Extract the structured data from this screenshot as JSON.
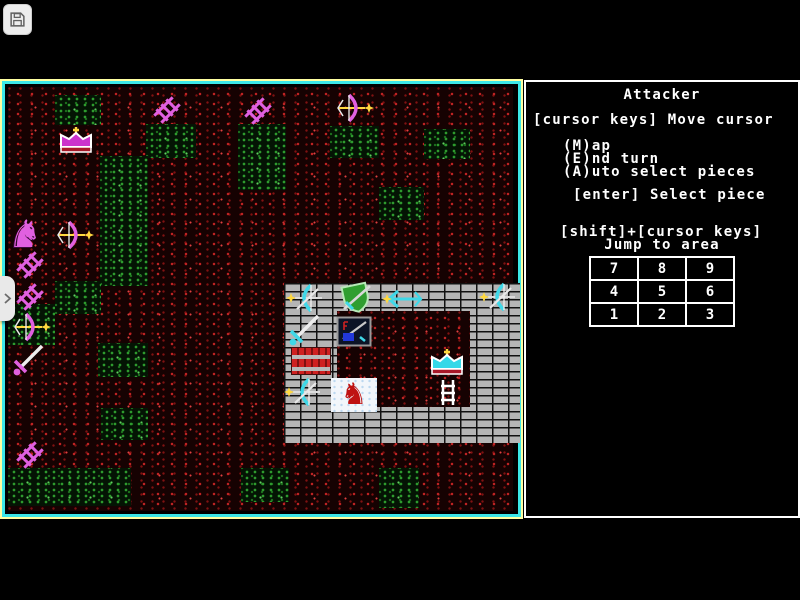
{
  "toolbar": {
    "save_icon": "floppy-disk"
  },
  "drawer": {
    "icon": "chevron-right"
  },
  "sidebar": {
    "title": "Attacker",
    "lines": [
      "[cursor keys] Move cursor",
      "(M)ap",
      "(E)nd turn",
      "(A)uto select pieces",
      "[enter] Select piece",
      "[shift]+[cursor keys]",
      "Jump to area"
    ],
    "jump_grid": {
      "rows": [
        [
          "7",
          "8",
          "9"
        ],
        [
          "4",
          "5",
          "6"
        ],
        [
          "1",
          "2",
          "3"
        ]
      ]
    }
  },
  "colors": {
    "map_border_outer": "#ffffa2",
    "map_border_inner": "#3ce8e8",
    "sidebar_border": "#ffffff",
    "text": "#ffffff",
    "ground_red": "#c22424",
    "grass_green": "#2e9b2e",
    "brick_gray": "#b5b5b5",
    "piece_pink": "#e060e0",
    "piece_cyan": "#40d8e8",
    "star_yellow": "#ffd840",
    "shield_green": "#2f9e2f"
  },
  "map": {
    "green_patches": [
      [
        55,
        95,
        46,
        30
      ],
      [
        146,
        124,
        50,
        34
      ],
      [
        238,
        124,
        48,
        66
      ],
      [
        100,
        156,
        48,
        130
      ],
      [
        330,
        126,
        49,
        32
      ],
      [
        424,
        129,
        46,
        30
      ],
      [
        379,
        187,
        45,
        33
      ],
      [
        55,
        281,
        46,
        33
      ],
      [
        8,
        304,
        47,
        41
      ],
      [
        98,
        343,
        50,
        34
      ],
      [
        101,
        408,
        47,
        32
      ],
      [
        8,
        468,
        123,
        38
      ],
      [
        241,
        468,
        48,
        34
      ],
      [
        379,
        468,
        40,
        40
      ]
    ],
    "castle": {
      "x": 284,
      "y": 283,
      "w": 236,
      "h": 160,
      "courtyard": {
        "x": 337,
        "y": 311,
        "w": 133,
        "h": 96
      }
    },
    "pieces": [
      {
        "type": "ladder",
        "x": 152,
        "y": 95
      },
      {
        "type": "ladder",
        "x": 243,
        "y": 96
      },
      {
        "type": "bow-pink",
        "x": 335,
        "y": 93
      },
      {
        "type": "crown-magenta",
        "x": 57,
        "y": 126
      },
      {
        "type": "horse-pink",
        "x": 8,
        "y": 216
      },
      {
        "type": "bow-pink",
        "x": 55,
        "y": 220
      },
      {
        "type": "ladder",
        "x": 15,
        "y": 250
      },
      {
        "type": "ladder",
        "x": 15,
        "y": 282
      },
      {
        "type": "bow-pink",
        "x": 12,
        "y": 312
      },
      {
        "type": "sword-pink",
        "x": 10,
        "y": 342
      },
      {
        "type": "ladder",
        "x": 15,
        "y": 440
      },
      {
        "type": "bow-cyan",
        "x": 285,
        "y": 283
      },
      {
        "type": "shield-green",
        "x": 336,
        "y": 281
      },
      {
        "type": "arrow-cyan",
        "x": 382,
        "y": 288
      },
      {
        "type": "bow-cyan",
        "x": 478,
        "y": 282
      },
      {
        "type": "sword-cyan",
        "x": 286,
        "y": 312
      },
      {
        "type": "emblem",
        "x": 336,
        "y": 316
      },
      {
        "type": "crate",
        "x": 291,
        "y": 347
      },
      {
        "type": "crown-cyan",
        "x": 428,
        "y": 348
      },
      {
        "type": "bow-cyan",
        "x": 283,
        "y": 377
      },
      {
        "type": "horse-red-tile",
        "x": 331,
        "y": 378
      },
      {
        "type": "ladder-white",
        "x": 438,
        "y": 379
      }
    ]
  }
}
